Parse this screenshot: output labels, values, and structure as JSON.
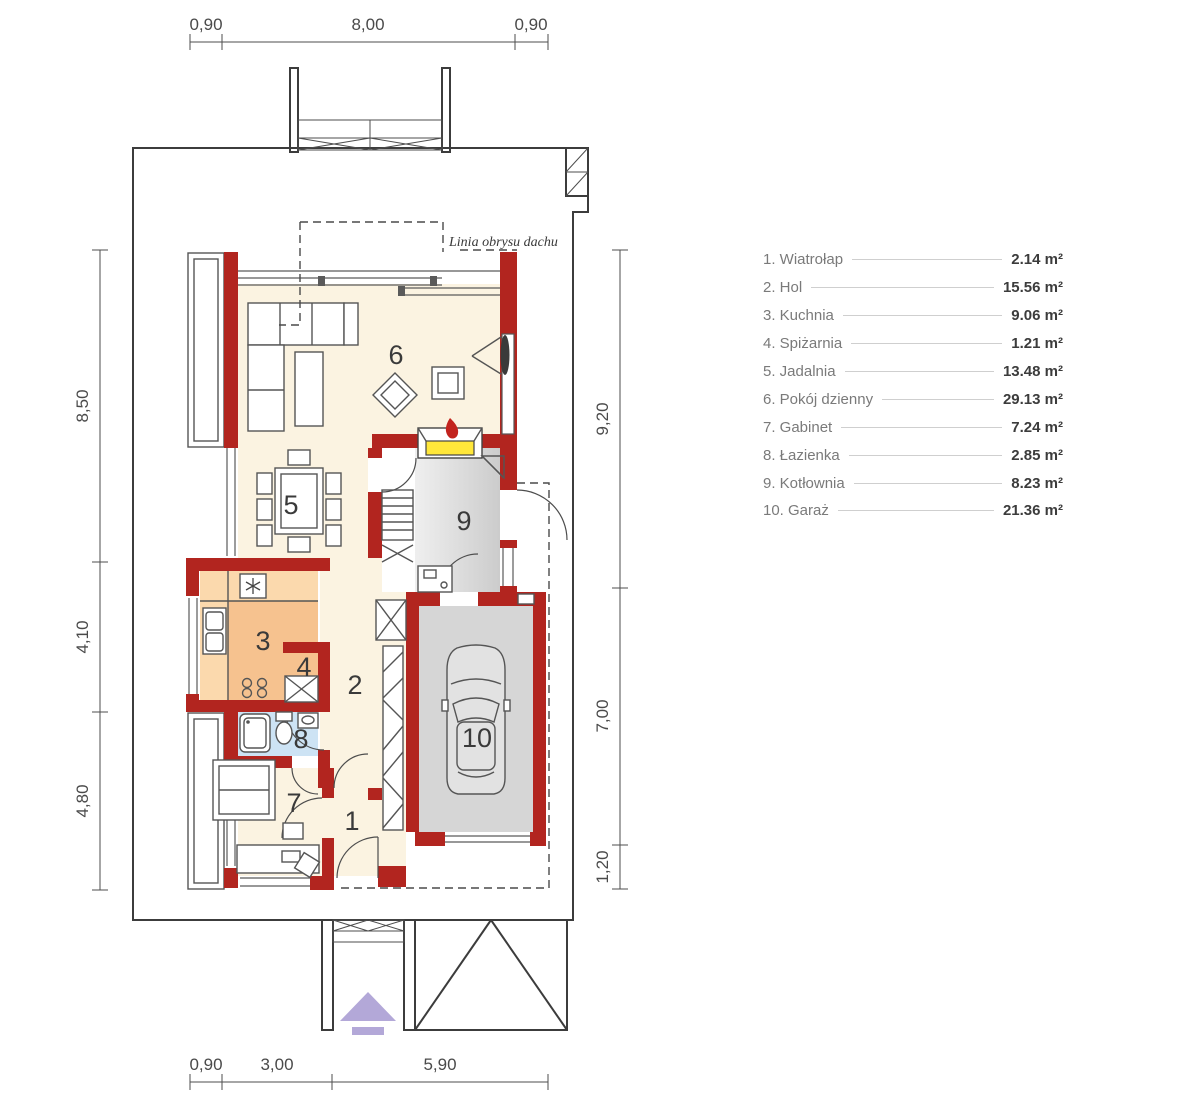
{
  "legend": {
    "items": [
      {
        "label": "1. Wiatrołap",
        "area": "2.14 m²"
      },
      {
        "label": "2. Hol",
        "area": "15.56 m²"
      },
      {
        "label": "3. Kuchnia",
        "area": "9.06 m²"
      },
      {
        "label": "4. Spiżarnia",
        "area": "1.21 m²"
      },
      {
        "label": "5. Jadalnia",
        "area": "13.48 m²"
      },
      {
        "label": "6. Pokój dzienny",
        "area": "29.13 m²"
      },
      {
        "label": "7. Gabinet",
        "area": "7.24 m²"
      },
      {
        "label": "8. Łazienka",
        "area": "2.85 m²"
      },
      {
        "label": "9. Kotłownia",
        "area": "8.23 m²"
      },
      {
        "label": "10. Garaż",
        "area": "21.36 m²"
      }
    ]
  },
  "plan": {
    "roof_outline_label": "Linia obrysu dachu",
    "room_numbers": [
      "1",
      "2",
      "3",
      "4",
      "5",
      "6",
      "7",
      "8",
      "9",
      "10"
    ]
  },
  "dimensions": {
    "top": [
      "0,90",
      "8,00",
      "0,90"
    ],
    "bottom": [
      "0,90",
      "3,00",
      "5,90"
    ],
    "left": [
      "8,50",
      "4,10",
      "4,80"
    ],
    "right": [
      "9,20",
      "7,00",
      "1,20"
    ]
  },
  "colors": {
    "wall": "#b2251f",
    "floor_cream": "#fbf3e1",
    "kitchen_floor": "#f6c28f",
    "kitchen_counter": "#fbd9ad",
    "bathroom": "#cde3f4",
    "utility_gray": "#d6d6d6",
    "fireplace_yellow": "#ffe73a",
    "entrance_arrow": "#b3a8d8"
  }
}
